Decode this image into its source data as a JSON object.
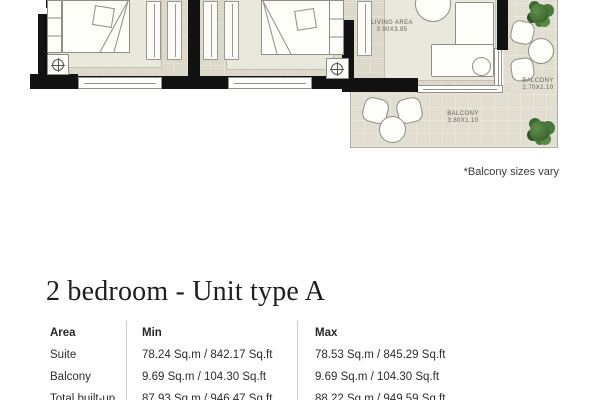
{
  "floor_plan": {
    "living_area": {
      "label": "LIVING AREA",
      "dimensions": "3.90X3.85"
    },
    "balcony_right": {
      "label": "BALCONY",
      "dimensions": "2.70X1.10"
    },
    "balcony_bottom": {
      "label": "BALCONY",
      "dimensions": "3.80X1.10"
    },
    "note": "*Balcony sizes vary",
    "icons": {
      "plant_icon": "green shrub cluster (css circles)",
      "ceiling-fixture_icon": "circle with cross ⊕",
      "wardrobe_icon": "rectangle with center rail line",
      "window_icon": "white band with glass line"
    },
    "colors": {
      "wall": "#121212",
      "room_floor": "#dcd8ca",
      "balcony_floor": "#e1ddd0",
      "rug": "#eae7dc",
      "furniture_outline": "#8f8f85",
      "plant_green": "#3c6a31"
    }
  },
  "unit": {
    "title": "2 bedroom - Unit type A"
  },
  "table": {
    "headers": [
      "Area",
      "Min",
      "Max"
    ],
    "rows": [
      {
        "area": "Suite",
        "min": "78.24 Sq.m / 842.17 Sq.ft",
        "max": "78.53 Sq.m / 845.29 Sq.ft"
      },
      {
        "area": "Balcony",
        "min": "9.69 Sq.m / 104.30 Sq.ft",
        "max": "9.69 Sq.m / 104.30 Sq.ft"
      },
      {
        "area": "Total built-up",
        "min": "87.93 Sq.m / 946.47 Sq.ft",
        "max": "88.22 Sq.m / 949.59 Sq.ft"
      }
    ]
  }
}
